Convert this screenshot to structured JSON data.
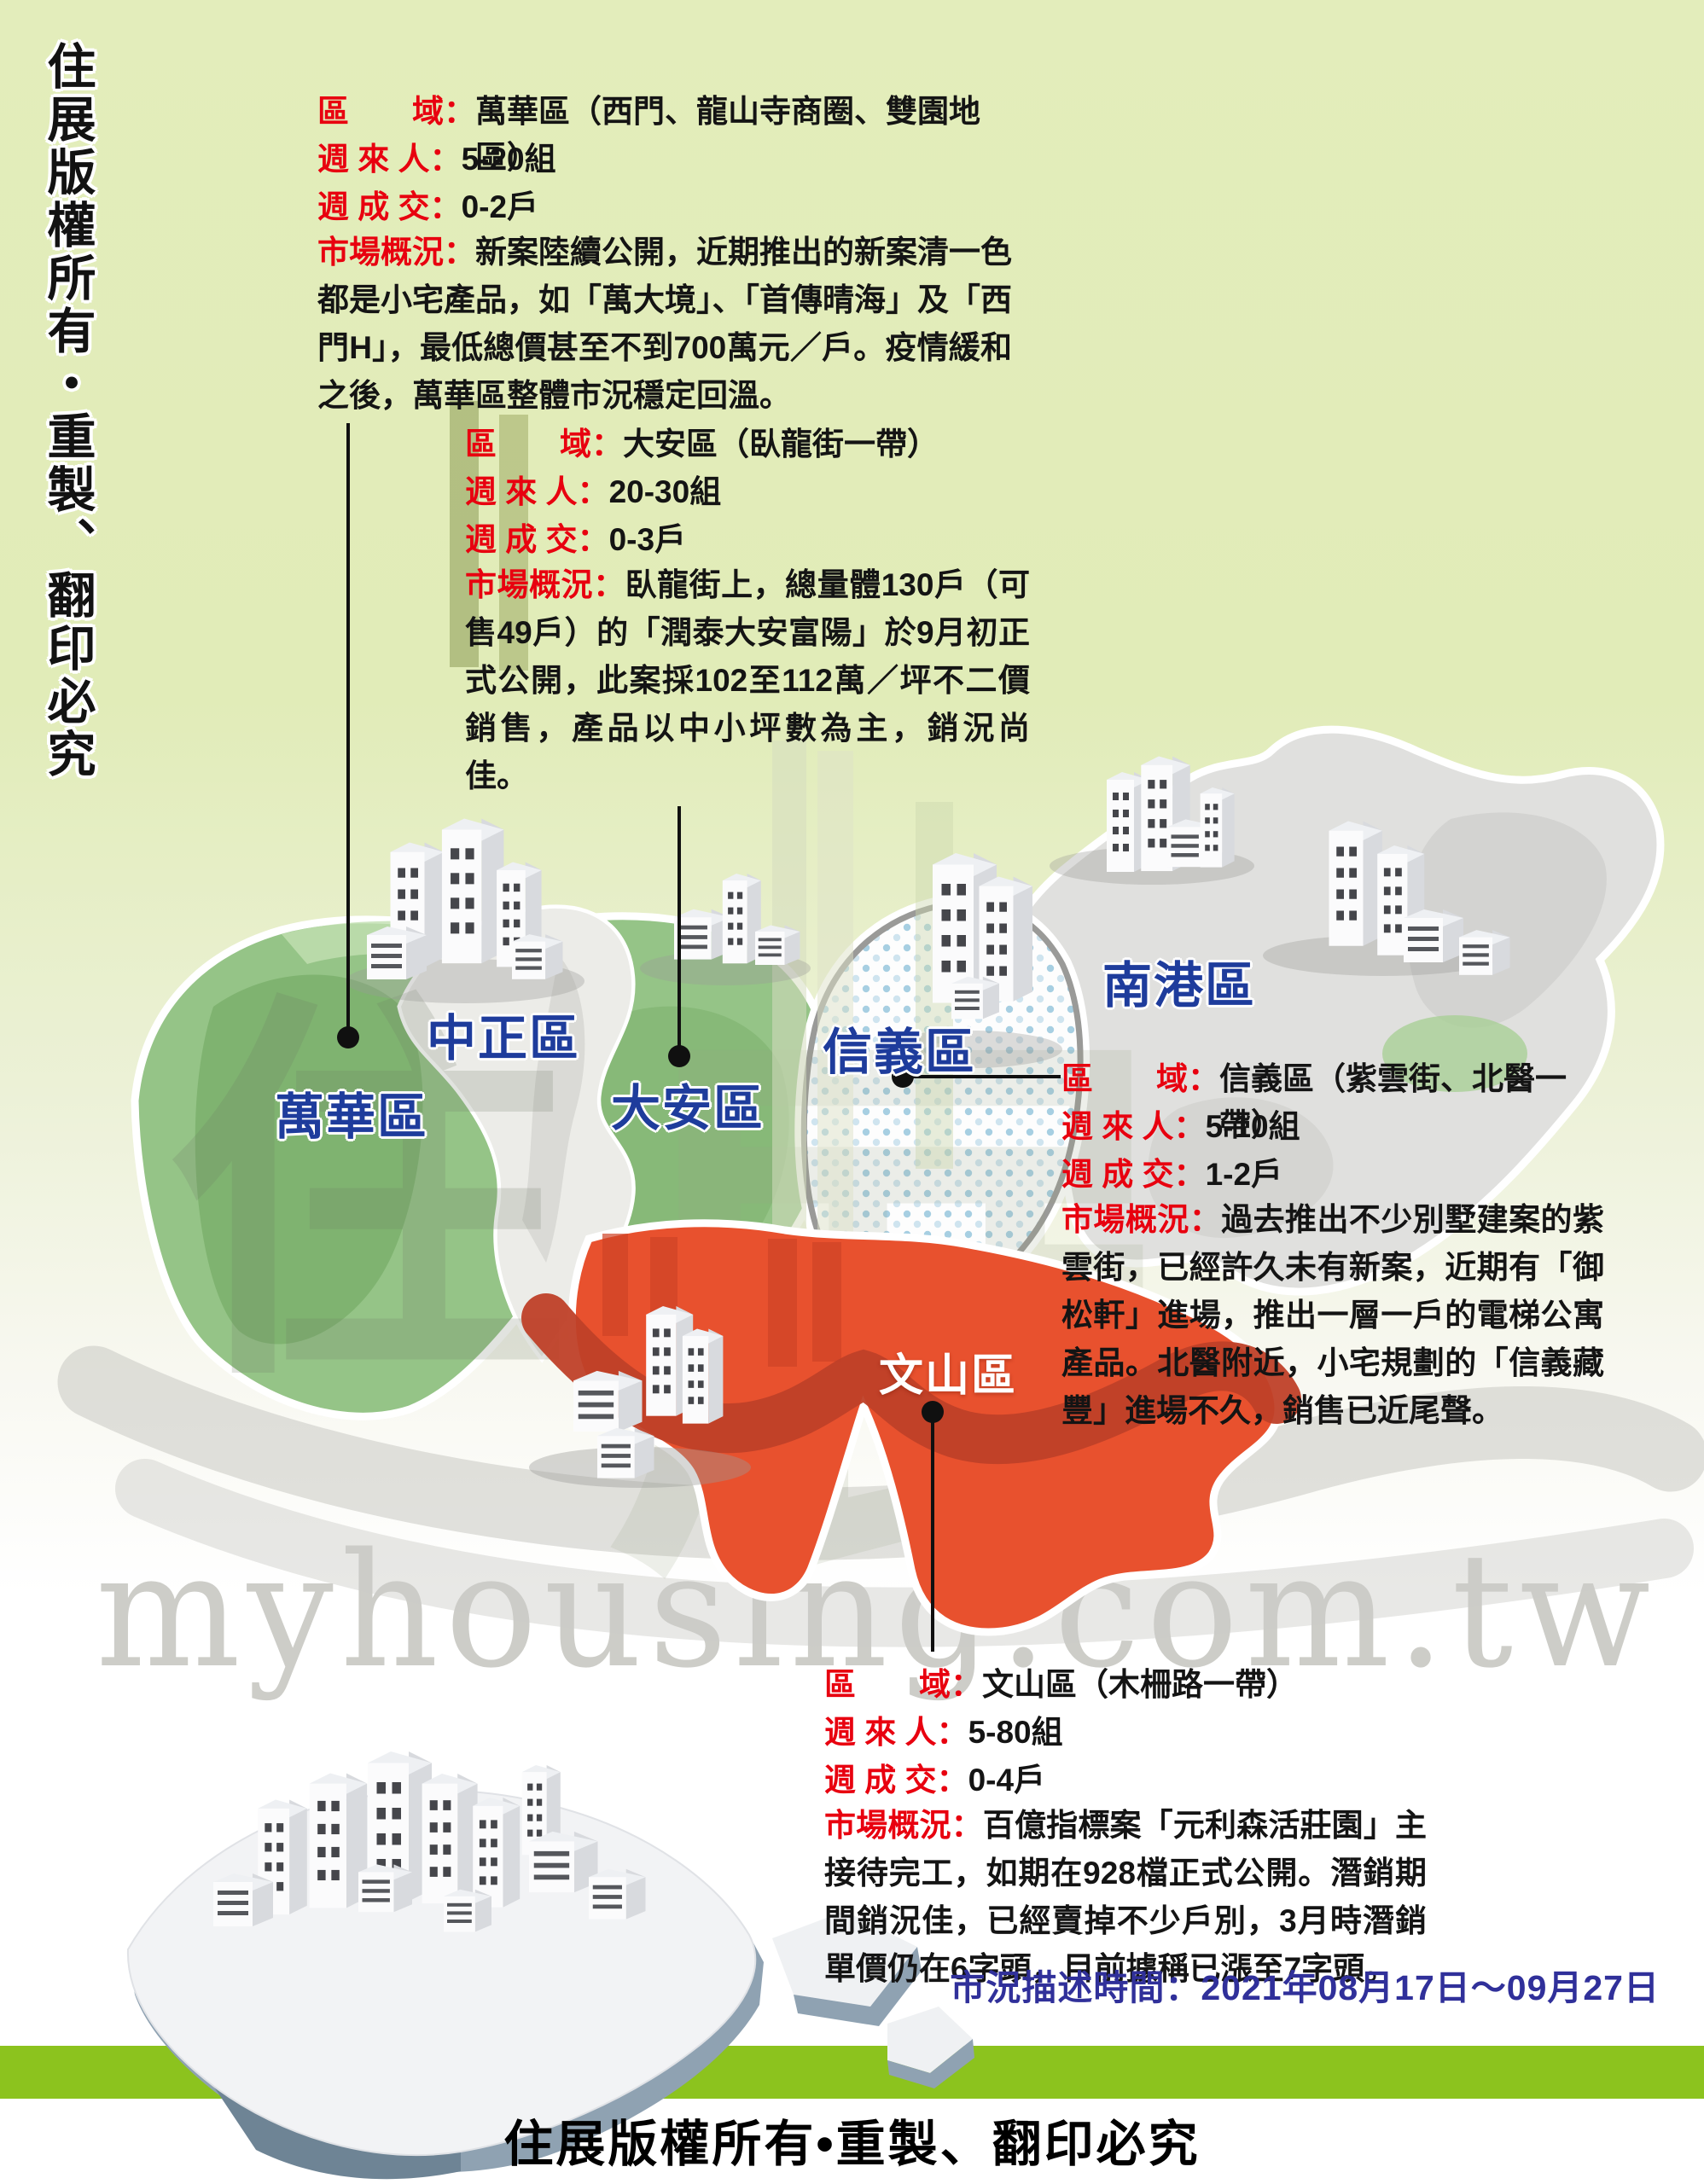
{
  "page": {
    "side_copyright": "住展版權所有・重製、翻印必究",
    "footer_copyright": "住展版權所有•重製、翻印必究",
    "survey_period": "市況描述時間：2021年08月17日～09月27日",
    "watermark_domain": "myhousing.com.tw",
    "watermark_glyph_left": "住",
    "watermark_glyph_right": "展"
  },
  "colors": {
    "background_top": "#e3edbb",
    "green_district": "#95c487",
    "gray_district": "#e0e0de",
    "red_district": "#e8512e",
    "red_band": "#bf4028",
    "label_blue": "#1e3c9c",
    "label_red": "#e8000f",
    "green_bar": "#8cc31e",
    "survey_blue": "#30309a"
  },
  "map": {
    "districts": [
      {
        "name": "萬華區",
        "style": "green"
      },
      {
        "name": "中正區",
        "style": "gray"
      },
      {
        "name": "大安區",
        "style": "green"
      },
      {
        "name": "信義區",
        "style": "dotted"
      },
      {
        "name": "南港區",
        "style": "gray"
      },
      {
        "name": "文山區",
        "style": "red"
      }
    ]
  },
  "callouts": [
    {
      "district": "萬華區",
      "fields": [
        {
          "label": "區　　域：",
          "value": "萬華區（西門、龍山寺商圈、雙園地區）"
        },
        {
          "label": "週 來 人：",
          "value": "5-20組"
        },
        {
          "label": "週 成 交：",
          "value": "0-2戶"
        }
      ],
      "market_label": "市場概況：",
      "market_text": "新案陸續公開，近期推出的新案清一色都是小宅產品，如「萬大境」、「首傳晴海」及「西門H」，最低總價甚至不到700萬元／戶。疫情緩和之後，萬華區整體市況穩定回溫。"
    },
    {
      "district": "大安區",
      "fields": [
        {
          "label": "區　　域：",
          "value": "大安區（臥龍街一帶）"
        },
        {
          "label": "週 來 人：",
          "value": "20-30組"
        },
        {
          "label": "週 成 交：",
          "value": "0-3戶"
        }
      ],
      "market_label": "市場概況：",
      "market_text": "臥龍街上，總量體130戶（可售49戶）的「潤泰大安富陽」於9月初正式公開，此案採102至112萬／坪不二價銷售，產品以中小坪數為主，銷況尚佳。"
    },
    {
      "district": "信義區",
      "fields": [
        {
          "label": "區　　域：",
          "value": "信義區（紫雲街、北醫一帶）"
        },
        {
          "label": "週 來 人：",
          "value": "5-10組"
        },
        {
          "label": "週 成 交：",
          "value": "1-2戶"
        }
      ],
      "market_label": "市場概況：",
      "market_text": "過去推出不少別墅建案的紫雲街，已經許久未有新案，近期有「御松軒」進場，推出一層一戶的電梯公寓產品。北醫附近，小宅規劃的「信義藏豐」進場不久，銷售已近尾聲。"
    },
    {
      "district": "文山區",
      "fields": [
        {
          "label": "區　　域：",
          "value": "文山區（木柵路一帶）"
        },
        {
          "label": "週 來 人：",
          "value": "5-80組"
        },
        {
          "label": "週 成 交：",
          "value": "0-4戶"
        }
      ],
      "market_label": "市場概況：",
      "market_text": "百億指標案「元利森活莊園」主接待完工，如期在928檔正式公開。潛銷期間銷況佳，已經賣掉不少戶別，3月時潛銷單價仍在6字頭，目前據稱已漲至7字頭。"
    }
  ]
}
